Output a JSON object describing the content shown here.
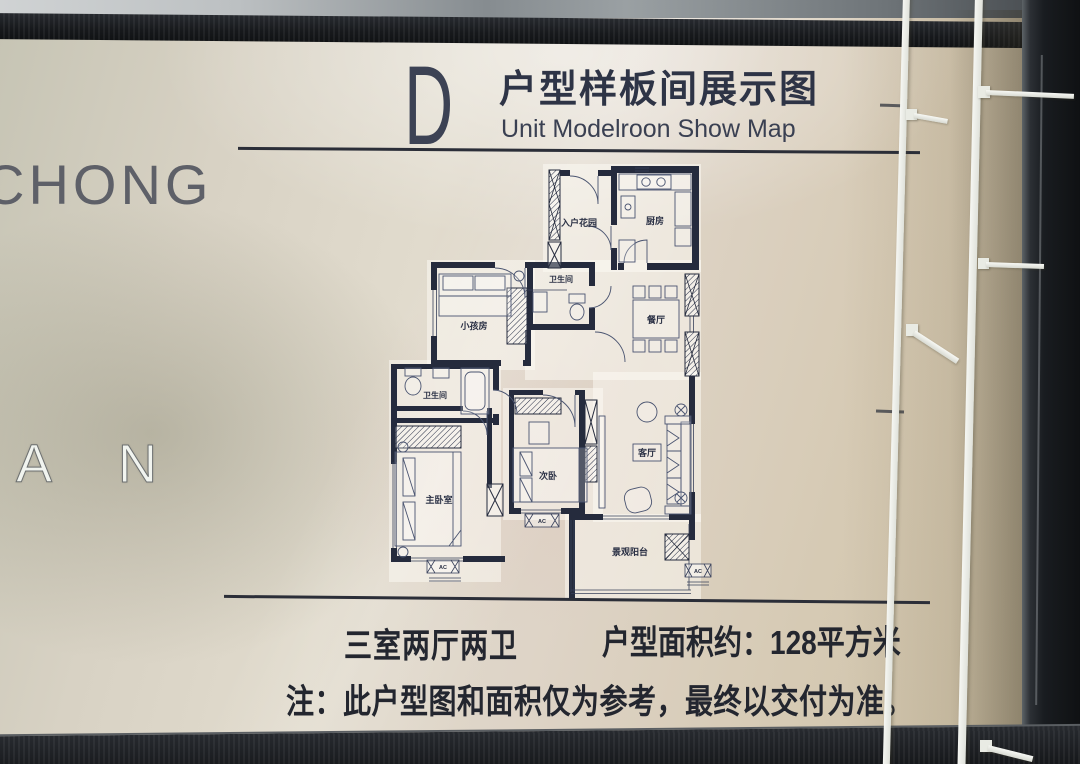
{
  "board": {
    "unit_letter": "D",
    "title_cn": "户型样板间展示图",
    "title_en": "Unit Modelroon Show Map",
    "spec_rooms": "三室两厅两卫",
    "spec_area": "户型面积约：128平方米",
    "note": "注：此户型图和面积仅为参考，最终以交付为准。"
  },
  "background_text": {
    "brand_partial": "CHONG",
    "letter_a": "A",
    "letter_n": "N"
  },
  "floorplan": {
    "rooms": {
      "entry_garden": "入户花园",
      "kitchen": "厨房",
      "bathroom_upper": "卫生间",
      "dining_room": "餐厅",
      "kids_room": "小孩房",
      "bathroom_lower": "卫生间",
      "master_bedroom": "主卧室",
      "second_bedroom": "次卧",
      "living_room": "客厅",
      "balcony": "景观阳台"
    },
    "ac_label": "AC"
  },
  "colors": {
    "panel_beige": "#d9d2c2",
    "frame_dark": "#17191c",
    "wall_navy": "#252b3d",
    "text_dark": "#23262f",
    "cable_white": "#f0f1ed"
  }
}
